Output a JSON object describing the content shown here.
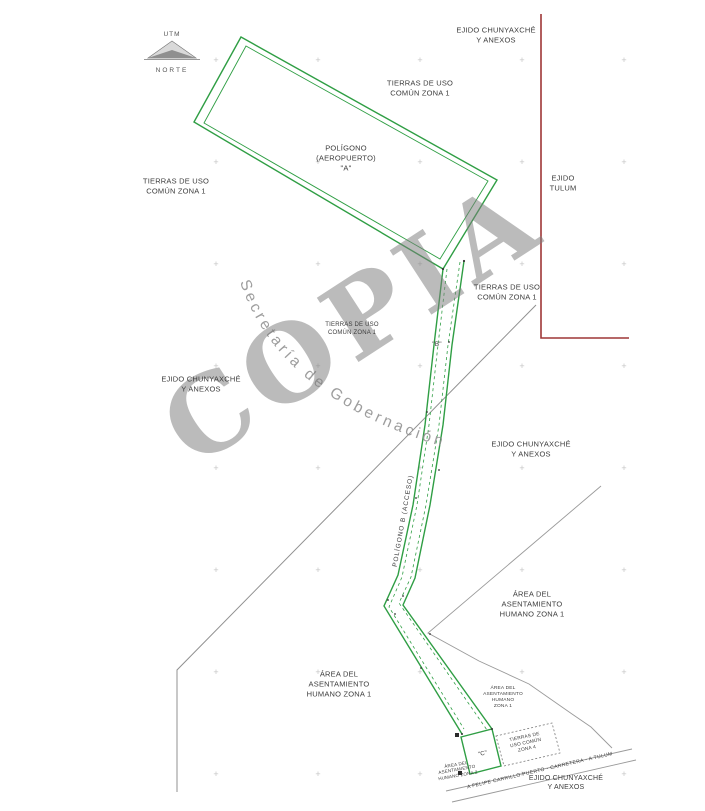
{
  "colors": {
    "boundary_green": "#2f9e44",
    "boundary_red": "#9e3636",
    "boundary_gray": "#8f8f8f",
    "grid_cross": "#c4c4c4",
    "watermark_gray": "#8d8d8d",
    "label_text": "#3c3c3c"
  },
  "north_arrow": {
    "utm": "UTM",
    "norte": "NORTE"
  },
  "watermark": {
    "title": "COPIA",
    "subtitle": "Secretaría de Gobernación"
  },
  "labels": {
    "ejido_chunyaxche_top": {
      "text": "EJIDO CHUNYAXCHÉ\nY ANEXOS"
    },
    "tierras_uso_top": {
      "text": "TIERRAS DE USO\nCOMÚN ZONA 1"
    },
    "poligono_a": {
      "text": "POLÍGONO\n(AEROPUERTO)\n\"A\""
    },
    "tierras_uso_left": {
      "text": "TIERRAS DE USO\nCOMÚN ZONA 1"
    },
    "ejido_tulum": {
      "text": "EJIDO\nTULUM"
    },
    "tierras_uso_right": {
      "text": "TIERRAS DE USO\nCOMÚN ZONA 1"
    },
    "tierras_uso_center": {
      "text": "TIERRAS DE USO\nCOMÚN ZONA 1"
    },
    "ejido_chunyaxche_left": {
      "text": "EJIDO CHUNYAXCHÉ\nY ANEXOS"
    },
    "ejido_chunyaxche_right": {
      "text": "EJIDO CHUNYAXCHÉ\nY ANEXOS"
    },
    "poligono_b": {
      "text": "\"B\""
    },
    "poligono_b_acceso": {
      "text": "POLÍGONO B (ACCESO)"
    },
    "area_asentamiento_right": {
      "text": "ÁREA DEL\nASENTAMIENTO\nHUMANO ZONA 1"
    },
    "area_asentamiento_left": {
      "text": "ÁREA DEL\nASENTAMIENTO\nHUMANO ZONA 1"
    },
    "area_asentamiento_small": {
      "text": "ÁREA DEL\nASENTAMIENTO\nHUMANO\nZONA 1"
    },
    "tierras_zona4": {
      "text": "TIERRAS DE\nUSO COMÚN\nZONA 4"
    },
    "area_asentamiento_zona2": {
      "text": "ÁREA DEL\nASENTAMIENTO\nHUMANO ZONA 2"
    },
    "poligono_c": {
      "text": "\"C\""
    },
    "road": {
      "text": "A FELIPE CARRILLO PUERTO - CARRETERA - A TULUM"
    },
    "ejido_chunyaxche_bottom": {
      "text": "EJIDO CHUNYAXCHÉ\nY ANEXOS"
    }
  },
  "grid": {
    "glyph": "+",
    "cols": [
      216,
      318,
      420,
      522,
      624
    ],
    "rows": [
      60,
      162,
      264,
      366,
      468,
      570,
      672,
      774
    ]
  }
}
